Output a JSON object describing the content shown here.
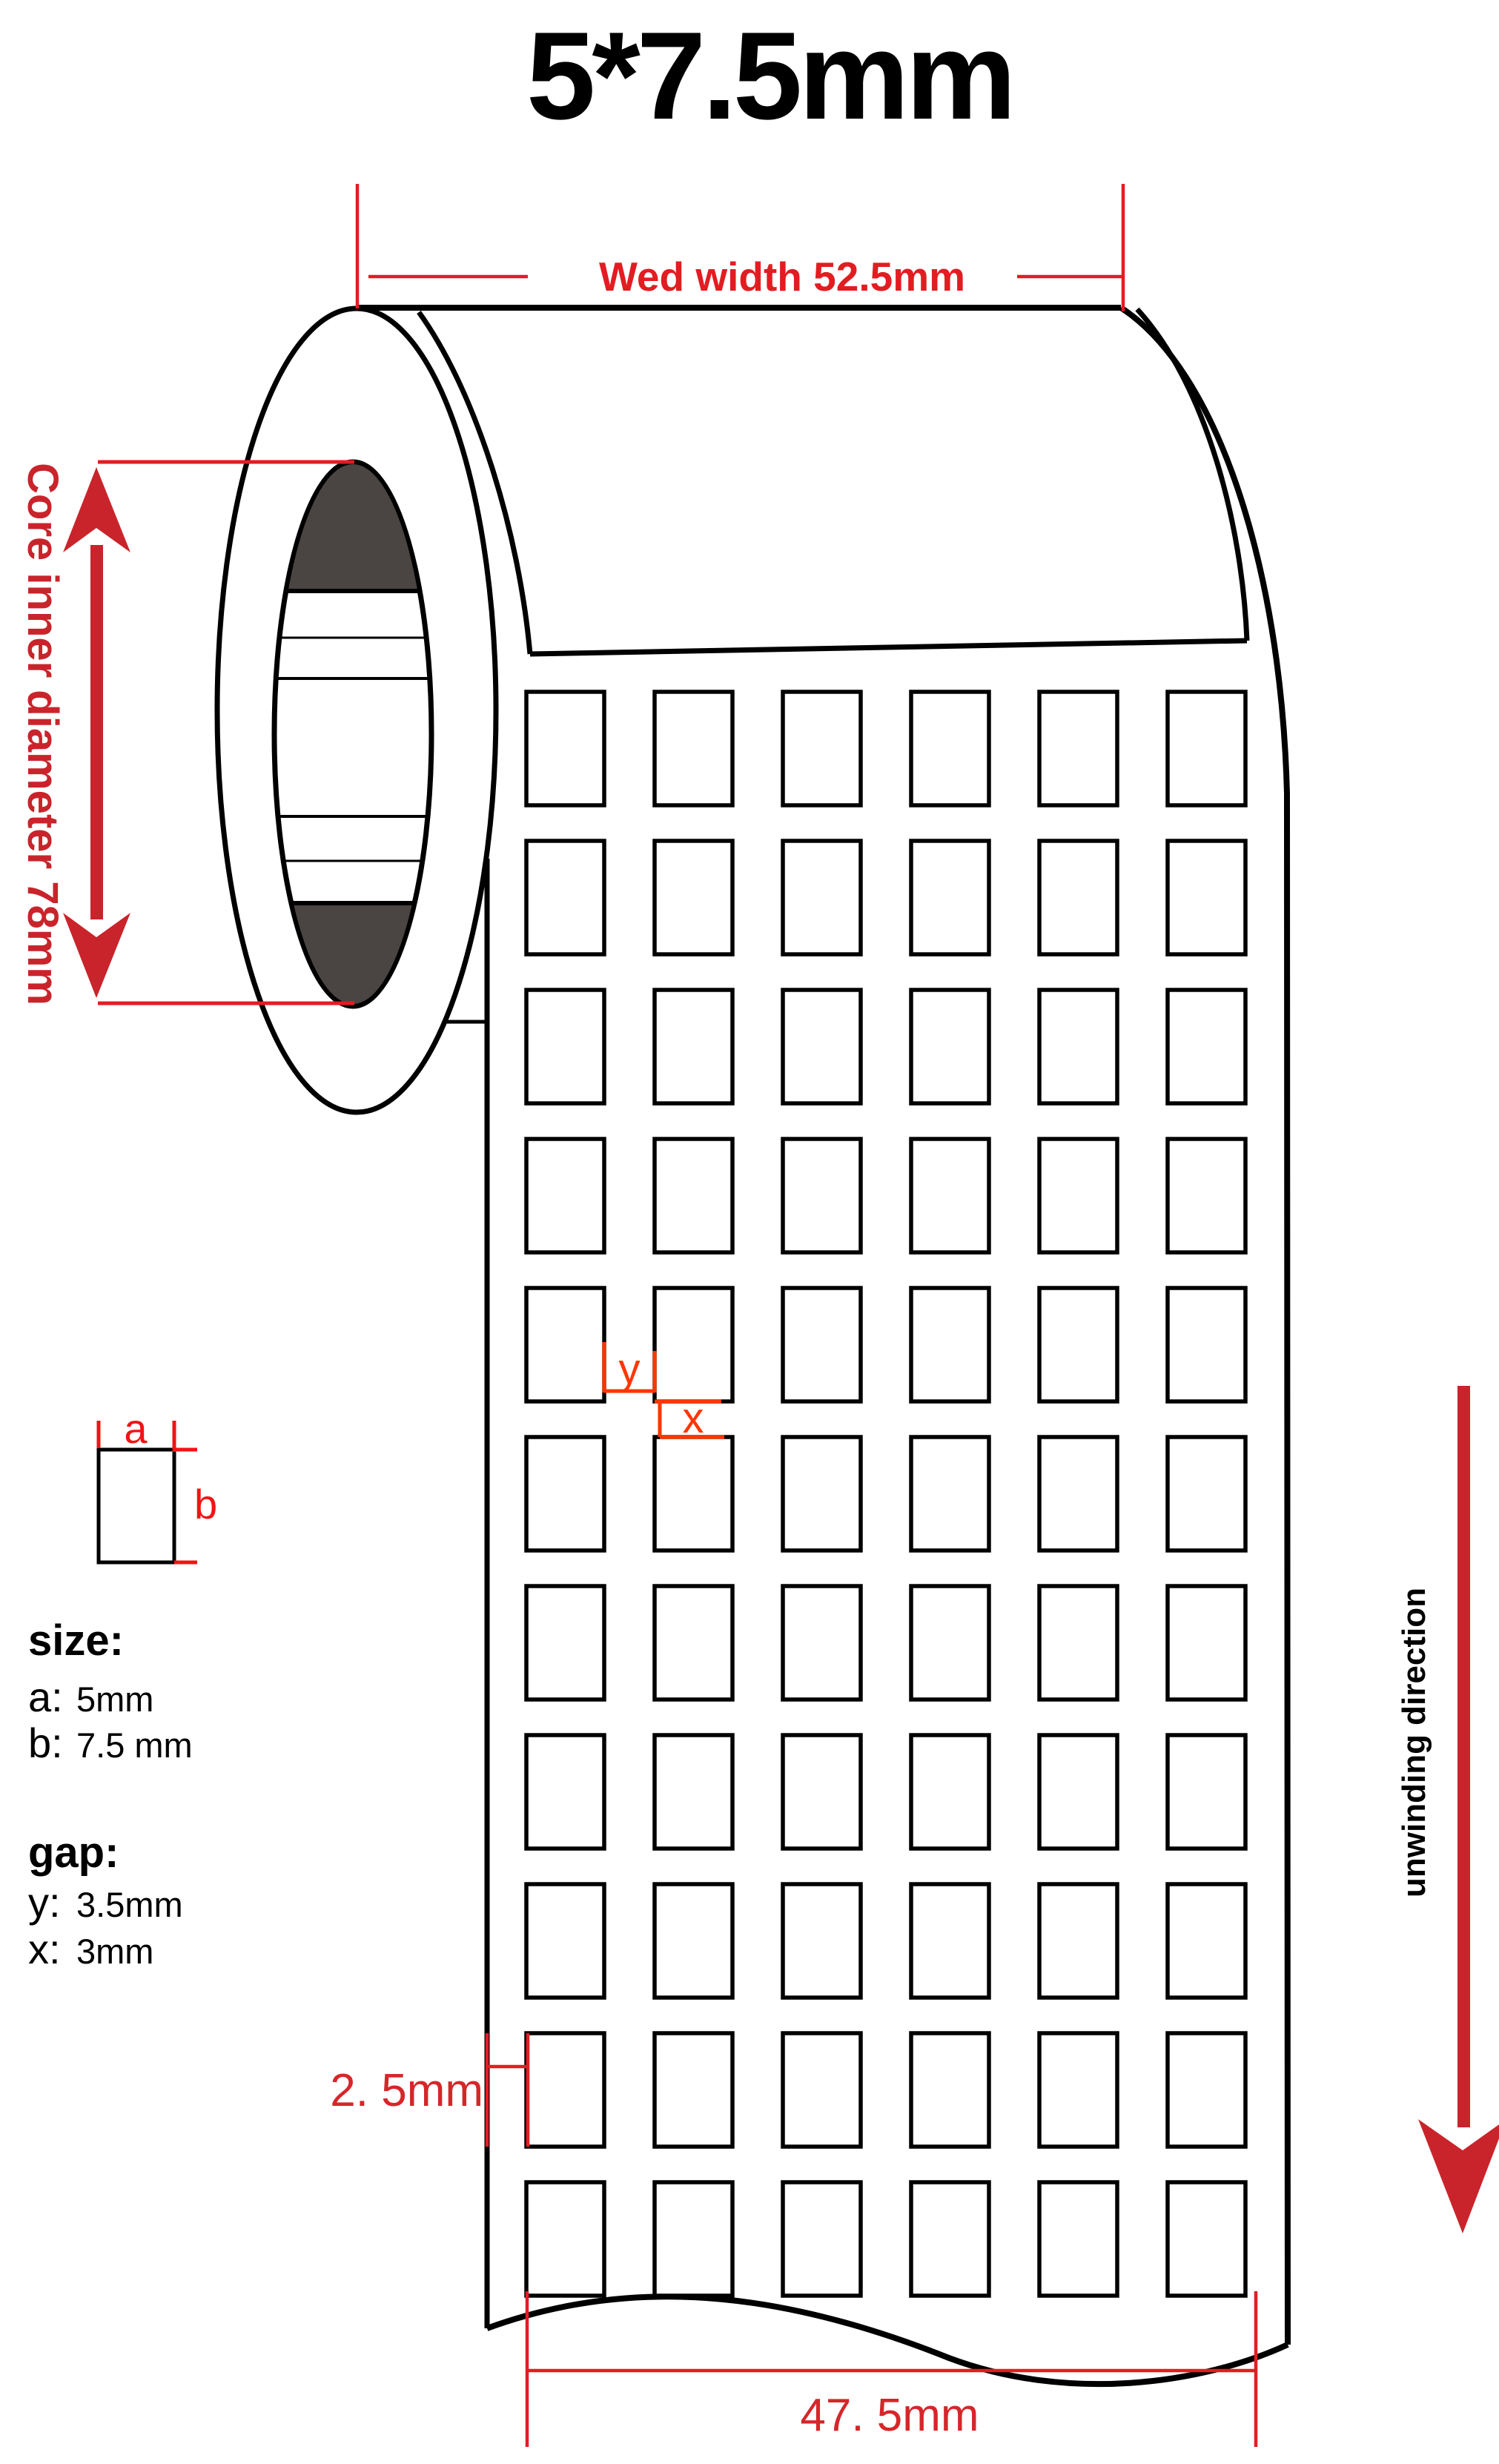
{
  "title": "5*7.5mm",
  "annotations": {
    "web_width": "Wed width 52.5mm",
    "core_diameter": "Core inner diameter 78mm",
    "unwinding_direction": "unwinding direction",
    "left_margin": "2. 5mm",
    "bottom_width": "47. 5mm",
    "dim_a": "a",
    "dim_b": "b",
    "dim_y": "y",
    "dim_x": "x"
  },
  "legend": {
    "size_heading": "size:",
    "size_a_label": "a:",
    "size_a_value": "5mm",
    "size_b_label": "b:",
    "size_b_value": "7.5 mm",
    "gap_heading": "gap:",
    "gap_y_label": "y:",
    "gap_y_value": "3.5mm",
    "gap_x_label": "x:",
    "gap_x_value": "3mm"
  },
  "grid": {
    "columns": 6,
    "rows": 11
  },
  "colors": {
    "dimension_red": "#e21d22",
    "arrow_dark_red": "#c9242b",
    "xy_orange_red": "#ff3600",
    "ab_red": "#f01414",
    "core_dark": "#4a4442",
    "line_black": "#000000"
  }
}
